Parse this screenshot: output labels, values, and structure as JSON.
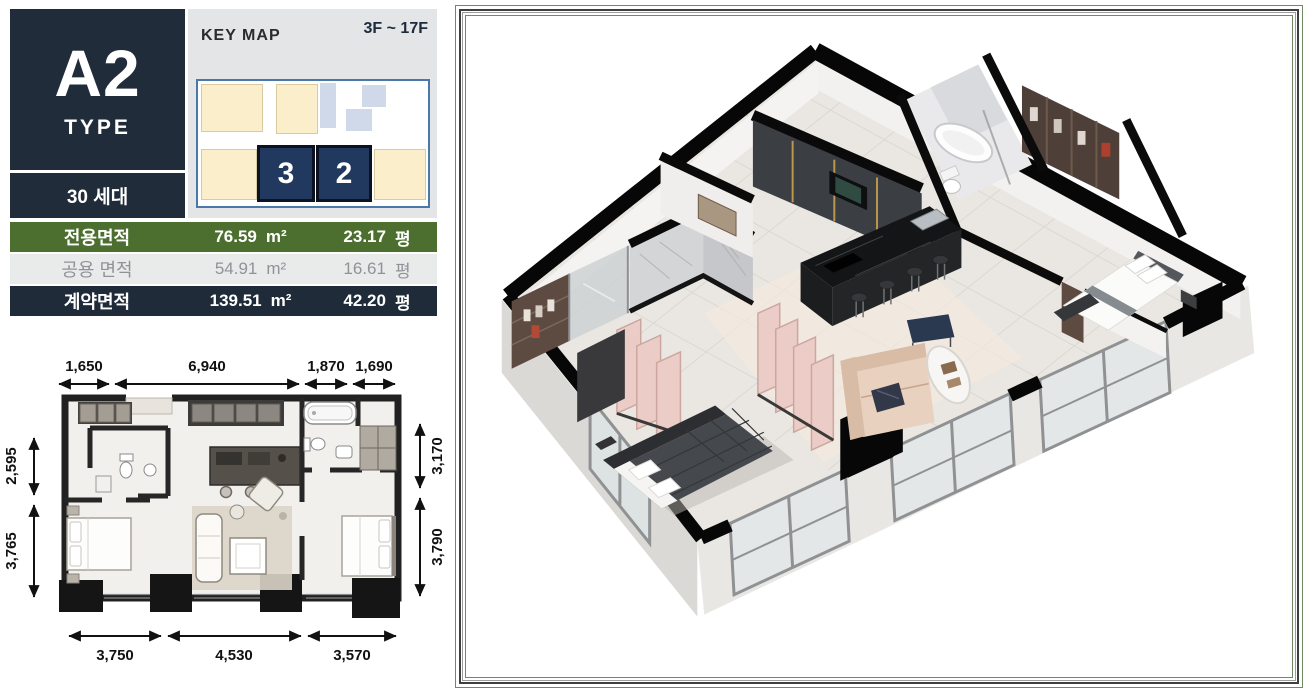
{
  "unit_card": {
    "code": "A2",
    "type_label": "TYPE",
    "households": "30 세대"
  },
  "key_map": {
    "title": "KEY MAP",
    "floor_range": "3F ~ 17F",
    "highlighted_units": {
      "left": "3",
      "right": "2"
    }
  },
  "area_table": {
    "rows": [
      {
        "label": "전용면적",
        "area_m2": "76.59",
        "unit_m2": "m²",
        "area_pyeong": "23.17",
        "unit_pyeong": "평"
      },
      {
        "label": "공용 면적",
        "area_m2": "54.91",
        "unit_m2": "m²",
        "area_pyeong": "16.61",
        "unit_pyeong": "평"
      },
      {
        "label": "계약면적",
        "area_m2": "139.51",
        "unit_m2": "m²",
        "area_pyeong": "42.20",
        "unit_pyeong": "평"
      }
    ]
  },
  "floor_plan_2d": {
    "dims_top": [
      "1,650",
      "6,940",
      "1,870",
      "1,690"
    ],
    "dims_bottom": [
      "3,750",
      "4,530",
      "3,570"
    ],
    "dims_left": [
      "2,595",
      "3,765"
    ],
    "dims_right": [
      "3,170",
      "3,790"
    ]
  },
  "colors": {
    "navy": "#212c3a",
    "green_row": "#4c6f2f",
    "cream": "#faeecb",
    "keymap_navy": "#21395e",
    "frame_green": "#6d8a62"
  }
}
